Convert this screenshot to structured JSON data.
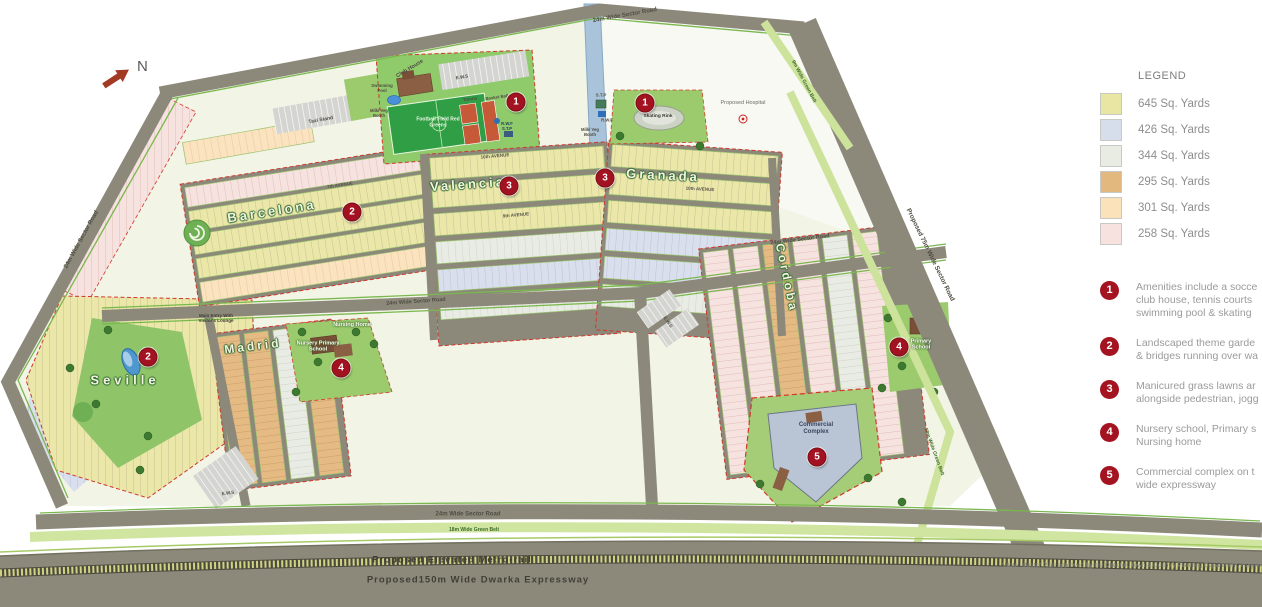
{
  "north": {
    "label": "N"
  },
  "legend": {
    "title": "LEGEND",
    "items": [
      {
        "label": "645 Sq. Yards",
        "color": "#e9e5a3"
      },
      {
        "label": "426 Sq. Yards",
        "color": "#d6ddeb"
      },
      {
        "label": "344 Sq. Yards",
        "color": "#e8ece3"
      },
      {
        "label": "295 Sq. Yards",
        "color": "#e3b87e"
      },
      {
        "label": "301 Sq. Yards",
        "color": "#fbe2ba"
      },
      {
        "label": "258 Sq. Yards",
        "color": "#f7e2e0"
      }
    ]
  },
  "amenities": [
    {
      "num": "1",
      "lines": [
        "Amenities include a socce",
        "club house, tennis courts",
        "swimming pool & skating"
      ]
    },
    {
      "num": "2",
      "lines": [
        "Landscaped theme garde",
        "& bridges running over wa"
      ]
    },
    {
      "num": "3",
      "lines": [
        "Manicured grass lawns ar",
        "alongside pedestrian, jogg"
      ]
    },
    {
      "num": "4",
      "lines": [
        "Nursery school, Primary s",
        "Nursing home"
      ]
    },
    {
      "num": "5",
      "lines": [
        "Commercial complex on t",
        "wide expressway"
      ]
    }
  ],
  "note": "*Note: Master Plan approved by the Director, Town & Country Planning Department, Haryana",
  "districts": {
    "seville": "Seville",
    "barcelona": "Barcelona",
    "madrid": "Madrid",
    "valencia": "Valencia",
    "granada": "Granada",
    "cordoba": "Cordoba"
  },
  "roads": {
    "top_sector": "24m Wide Sector Road",
    "left_sector": "24m Wide Sector Road",
    "mid_sector": "24m Wide Sector Road",
    "bottom_sector": "24m Wide Sector Road",
    "right_sector": "Proposed 75m Wide Sector Road",
    "belt9": "9m Wide Green Belt",
    "belt18_right": "18m Wide Green Belt",
    "belt18_bottom": "18m Wide Green Belt",
    "metro": "Proposed Elevated Metro-rail",
    "expressway": "Proposed150m Wide Dwarka Expressway",
    "avenues": [
      "7th AVENUE",
      "10th AVENUE",
      "9th AVENUE",
      "10th AVENUE"
    ]
  },
  "facilities": {
    "club_house": "Club House",
    "swimming_pool": "Swimming Pool",
    "taxi_stand": "Taxi Stand",
    "ews": "E.W.S",
    "football": "Football Field Red Greens",
    "tennis": "Tennis",
    "basket_ball": "Basket Ball",
    "rwf_stp": "R.W.F S.T.P",
    "stp": "S.T.P",
    "rwf": "R.W.F",
    "milk_booth": "Milk/ Veg Booth",
    "skating": "Skating Rink",
    "hospital": "Proposed Hospital",
    "nursing_home": "Nursing Home",
    "nursery_school": "Nursery Primary School",
    "primary_school": "Primary School",
    "commercial": "Commercial Complex",
    "main_entry": "Main Entry With Visitor's Lounge"
  },
  "markers": [
    {
      "num": "1",
      "x": 516,
      "y": 102
    },
    {
      "num": "1",
      "x": 645,
      "y": 103
    },
    {
      "num": "2",
      "x": 352,
      "y": 212
    },
    {
      "num": "2",
      "x": 148,
      "y": 357
    },
    {
      "num": "3",
      "x": 509,
      "y": 186
    },
    {
      "num": "3",
      "x": 605,
      "y": 178
    },
    {
      "num": "4",
      "x": 341,
      "y": 368
    },
    {
      "num": "4",
      "x": 899,
      "y": 347
    },
    {
      "num": "5",
      "x": 817,
      "y": 457
    }
  ]
}
